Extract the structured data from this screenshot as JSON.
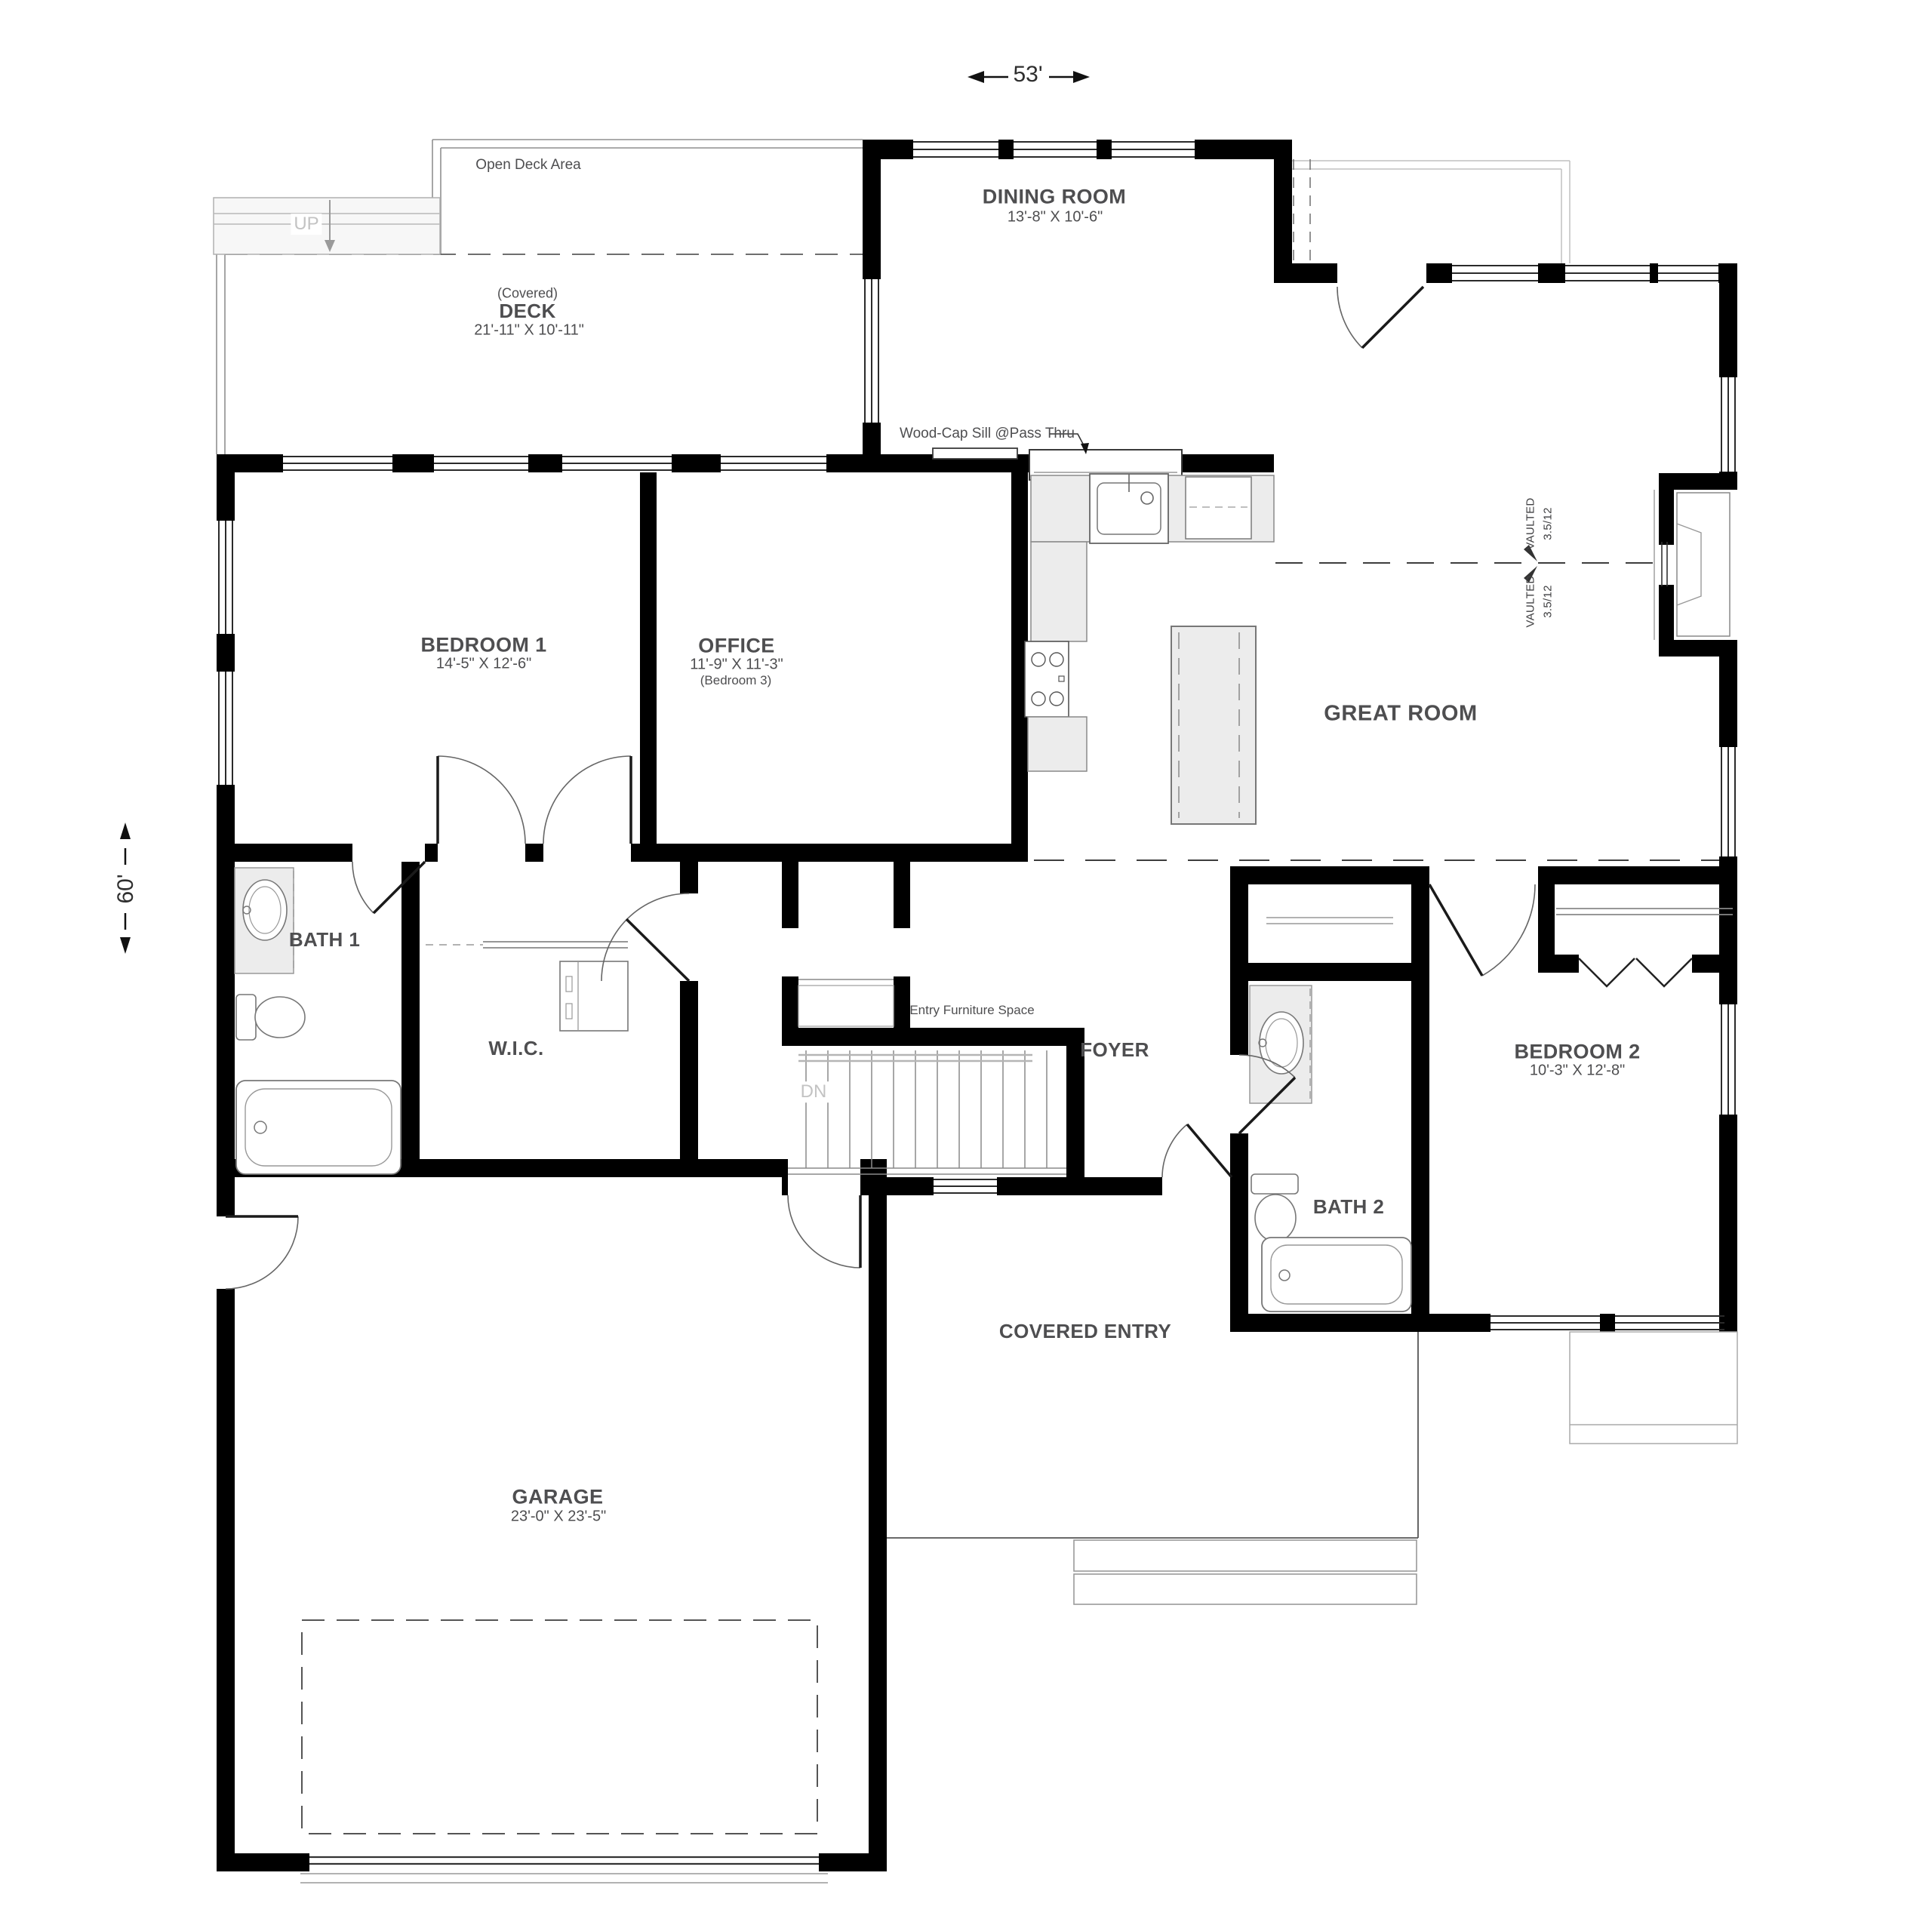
{
  "dimensions": {
    "width": "53'",
    "height": "60'"
  },
  "annotations": {
    "open_deck": "Open Deck Area",
    "up": "UP",
    "dn": "DN",
    "pass_thru": "Wood-Cap Sill @Pass Thru",
    "entry_furniture": "Entry Furniture Space",
    "vaulted": "VAULTED",
    "pitch": "3.5/12"
  },
  "rooms": {
    "dining": {
      "name": "DINING ROOM",
      "size": "13'-8\" X 10'-6\""
    },
    "deck": {
      "qualifier": "(Covered)",
      "name": "DECK",
      "size": "21'-11\" X 10'-11\""
    },
    "bedroom1": {
      "name": "BEDROOM 1",
      "size": "14'-5\" X 12'-6\""
    },
    "office": {
      "name": "OFFICE",
      "size": "11'-9\" X 11'-3\"",
      "alt": "(Bedroom 3)"
    },
    "great_room": {
      "name": "GREAT ROOM"
    },
    "bath1": {
      "name": "BATH 1"
    },
    "wic": {
      "name": "W.I.C."
    },
    "foyer": {
      "name": "FOYER"
    },
    "bedroom2": {
      "name": "BEDROOM 2",
      "size": "10'-3\" X 12'-8\""
    },
    "bath2": {
      "name": "BATH 2"
    },
    "covered_entry": {
      "name": "COVERED ENTRY"
    },
    "garage": {
      "name": "GARAGE",
      "size": "23'-0\" X 23'-5\""
    }
  }
}
